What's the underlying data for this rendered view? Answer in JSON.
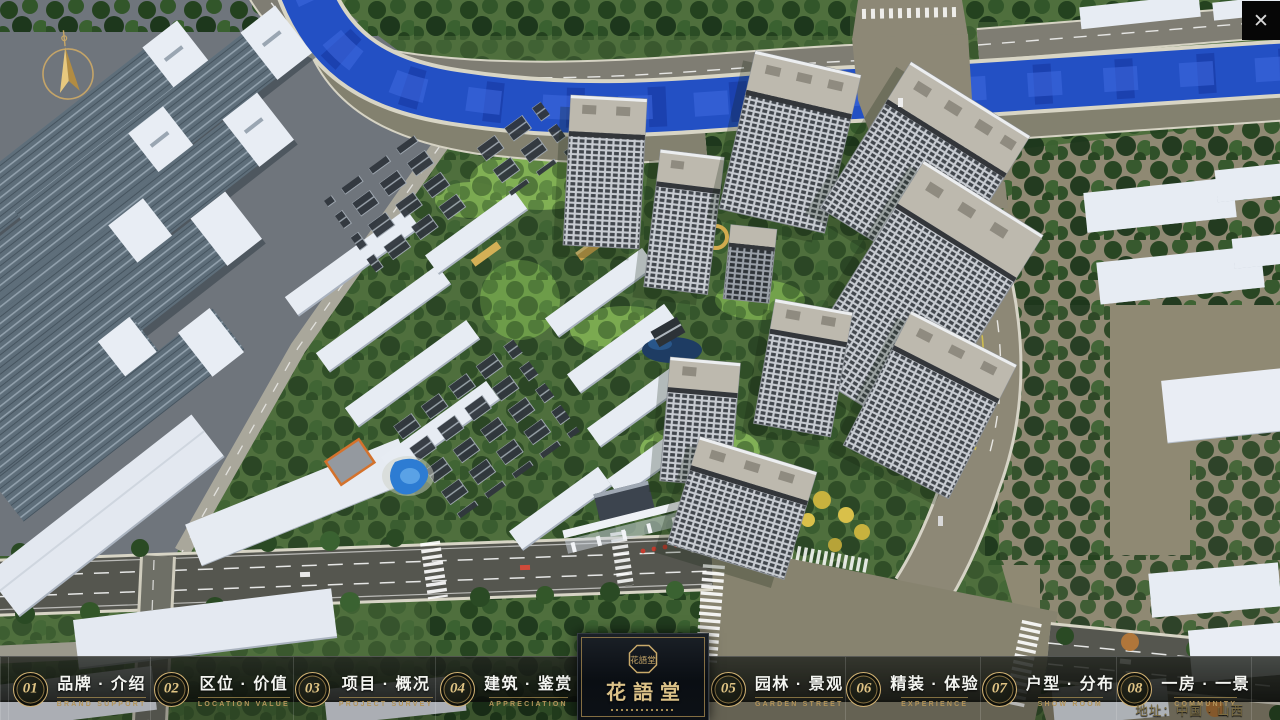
{
  "window": {
    "close_icon": "✕"
  },
  "logo": {
    "name": "花語堂",
    "seal_text": "花語堂"
  },
  "nav": {
    "items": [
      {
        "num": "01",
        "title": "品牌 · 介绍",
        "subtitle": "BRAND SUPPORT"
      },
      {
        "num": "02",
        "title": "区位 · 价值",
        "subtitle": "LOCATION VALUE"
      },
      {
        "num": "03",
        "title": "项目 · 概况",
        "subtitle": "PROJECT SURVEY"
      },
      {
        "num": "04",
        "title": "建筑 · 鉴赏",
        "subtitle": "APPRECIATION"
      },
      {
        "num": "05",
        "title": "园林 · 景观",
        "subtitle": "GARDEN STREET"
      },
      {
        "num": "06",
        "title": "精装 · 体验",
        "subtitle": "EXPERIENCE"
      },
      {
        "num": "07",
        "title": "户型 · 分布",
        "subtitle": "SHOW ROOM"
      },
      {
        "num": "08",
        "title": "一房 · 一景",
        "subtitle": "COMMUNITY"
      }
    ]
  },
  "footer": {
    "address": "地址：中国 · 山西"
  }
}
